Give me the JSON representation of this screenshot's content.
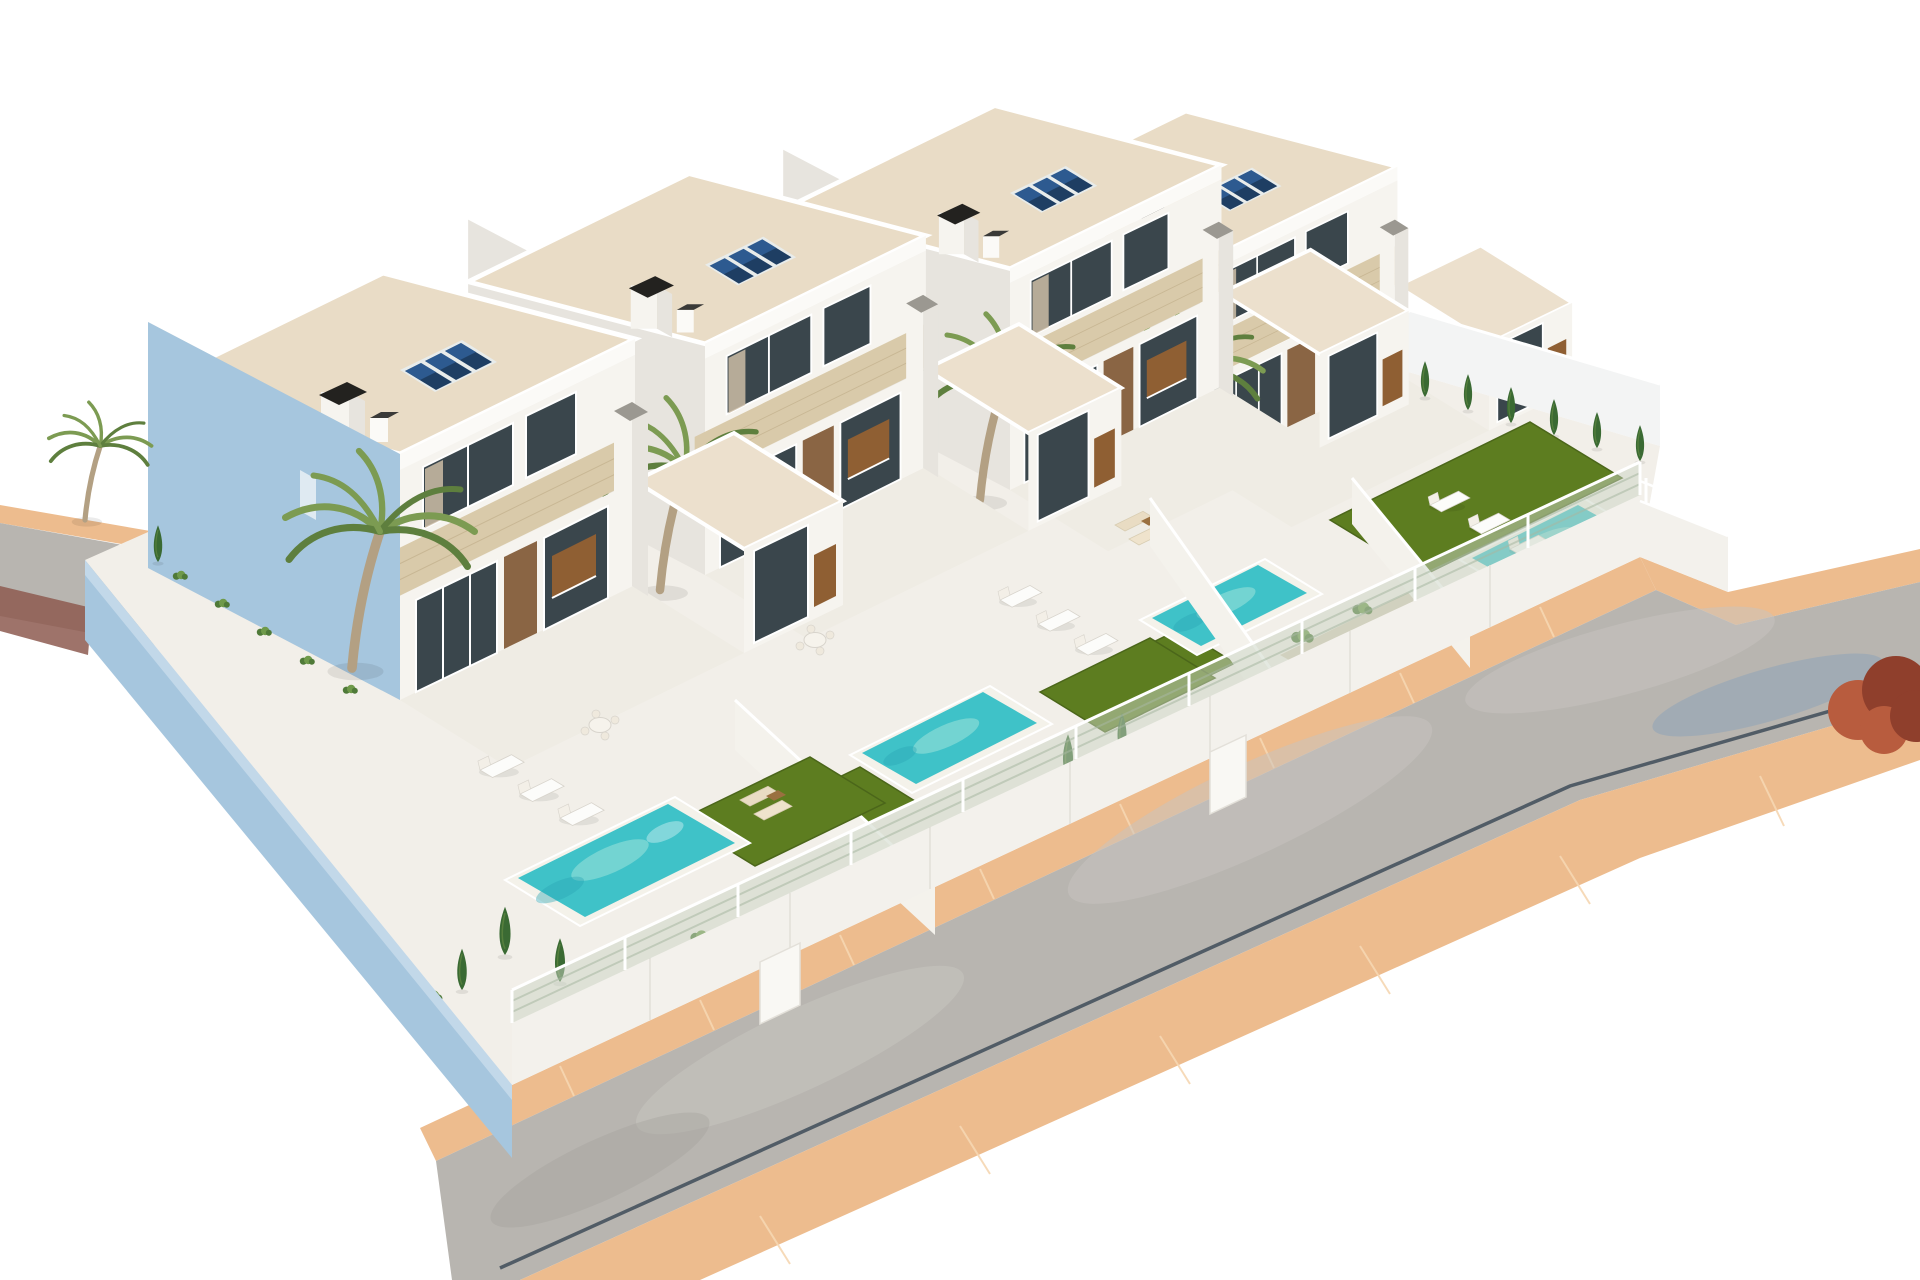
{
  "scene": {
    "type": "3d-architectural-render",
    "subject": "four modern two-storey white villas with private pools, gardens and solar panels on a corner plot beside a curved street",
    "background": "#ffffff",
    "palette": {
      "bg": "#ffffff",
      "wall_white": "#f6f4ef",
      "wall_bright": "#fbfaf7",
      "wall_shaded": "#e7e4de",
      "wall_blue": "#a6c6de",
      "wall_blue_light": "#cfe0ee",
      "stone": "#d9caaa",
      "stone_shaded": "#c9b793",
      "stone_joint": "#c2b08c",
      "roof_deck": "#e9dcc6",
      "roof_annex": "#ece0cd",
      "terrace": "#efece4",
      "platform": "#f2efe9",
      "divider": "#f4f2ec",
      "divider_shade": "#e0dcd3",
      "glass": "#3a464c",
      "glass_frame": "#ffffff",
      "curtain": "#cdbda6",
      "wood": "#8a6544",
      "cabinet": "#8f5f33",
      "pool_coping": "#f4f2ea",
      "pool_water": "#3fc2c8",
      "pool_light": "#9fe4da",
      "pool_deep": "#2ba4b4",
      "lawn": "#5d7d20",
      "lawn_dark": "#4b661a",
      "cypress": "#3a6a33",
      "cypress_light": "#567f3d",
      "shrub": "#4f7a38",
      "shrub_light": "#6f9a4a",
      "pebble": "#d9cfba",
      "pebble_dot": "#c4b89f",
      "palm_trunk": "#b3a083",
      "palm_frond": "#7c9b52",
      "palm_frond_dark": "#5e7f3e",
      "fence_panel": "#c9d3c4",
      "fence_stripe": "#a8b8a2",
      "white": "#ffffff",
      "sidewalk": "#edbc8e",
      "sidewalk_light": "#f6d7b2",
      "road": "#b8b5b0",
      "road_light": "#c7c4bf",
      "road_dark": "#a5a29d",
      "curb": "#46525e",
      "patch": "#8d5b50",
      "solar": "#1e3e63",
      "solar_light": "#31619b",
      "solar_frame": "#e8eceb",
      "chimney": "#23221f",
      "metal": "#9b9891",
      "tree_red": "#b85c3e",
      "tree_red_dark": "#8f3f2c",
      "shadow_blue": "#85a0bb",
      "shadow": "#d9d5ce"
    },
    "objects": {
      "villas": 4,
      "solar_panel_arrays": 4,
      "chimneys": 4,
      "roof_vents": 4,
      "annex_pylons": 4,
      "pools": 4,
      "lawn_patches": 5,
      "palm_trees": 5,
      "cypress_trees": 12,
      "shrub_clusters": 12,
      "sun_loungers": 9,
      "dining_sets": 2,
      "lounge_sets": 2,
      "plot_divider_walls": 3,
      "gate_panels": 2,
      "street_fence_posts": 11,
      "roads": 2,
      "sidewalk_bands": 3,
      "red_tree": 1
    }
  }
}
